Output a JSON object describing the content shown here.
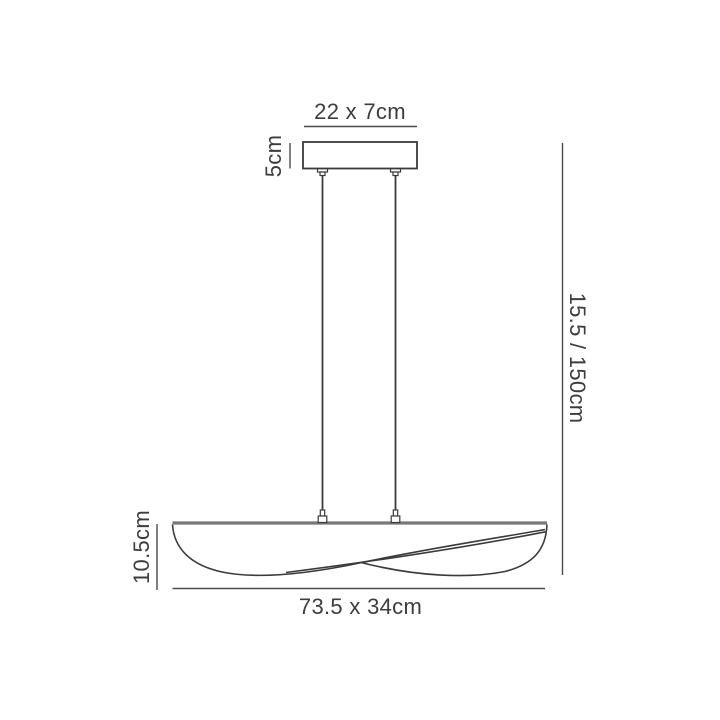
{
  "labels": {
    "canopy_width": "22 x 7cm",
    "canopy_height": "5cm",
    "drop_height": "15.5 / 150cm",
    "shade_height": "10.5cm",
    "shade_size": "73.5 x 34cm"
  },
  "colors": {
    "outline": "#3b3b3b",
    "dimension_line": "#4a4a4a",
    "shade_top_bar": "#787878",
    "text": "#3d3d3d",
    "background": "#ffffff"
  }
}
